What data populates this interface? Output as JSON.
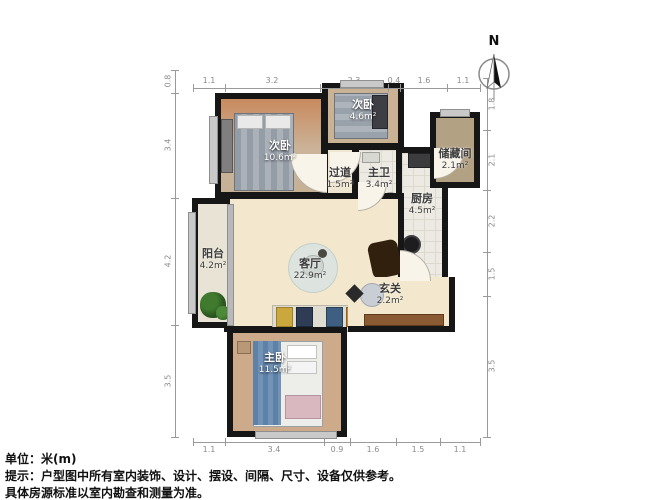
{
  "compass": {
    "label": "N"
  },
  "rooms": [
    {
      "name": "次卧",
      "area": "10.6m²"
    },
    {
      "name": "次卧",
      "area": "4.6m²"
    },
    {
      "name": "过道",
      "area": "1.5m²"
    },
    {
      "name": "主卫",
      "area": "3.4m²"
    },
    {
      "name": "厨房",
      "area": "4.5m²"
    },
    {
      "name": "储藏间",
      "area": "2.1m²"
    },
    {
      "name": "客厅",
      "area": "22.9m²"
    },
    {
      "name": "阳台",
      "area": "4.2m²"
    },
    {
      "name": "玄关",
      "area": "2.2m²"
    },
    {
      "name": "主卧",
      "area": "11.5m²"
    }
  ],
  "dimensions": {
    "top": [
      "1.1",
      "3.2",
      "2.3",
      "0.4",
      "1.6",
      "1.1"
    ],
    "bottom": [
      "1.1",
      "3.4",
      "0.9",
      "1.6",
      "1.5",
      "1.1"
    ],
    "left": [
      "0.8",
      "3.4",
      "4.2",
      "3.5"
    ],
    "right": [
      "1.8",
      "2.1",
      "2.2",
      "1.5",
      "3.5"
    ]
  },
  "footer": {
    "unit_line": "单位：米(m)",
    "note_line1": "提示：户型图中所有室内装饰、设计、摆设、间隔、尺寸、设备仅供参考。",
    "note_line2": "具体房源标准以室内勘查和测量为准。"
  },
  "colors": {
    "wall": "#161616",
    "bedroom_floor": "#cdab8a",
    "living_floor": "#f3e8ce",
    "tile_floor": "#eceae2",
    "dim_line": "#9a9a9a"
  }
}
